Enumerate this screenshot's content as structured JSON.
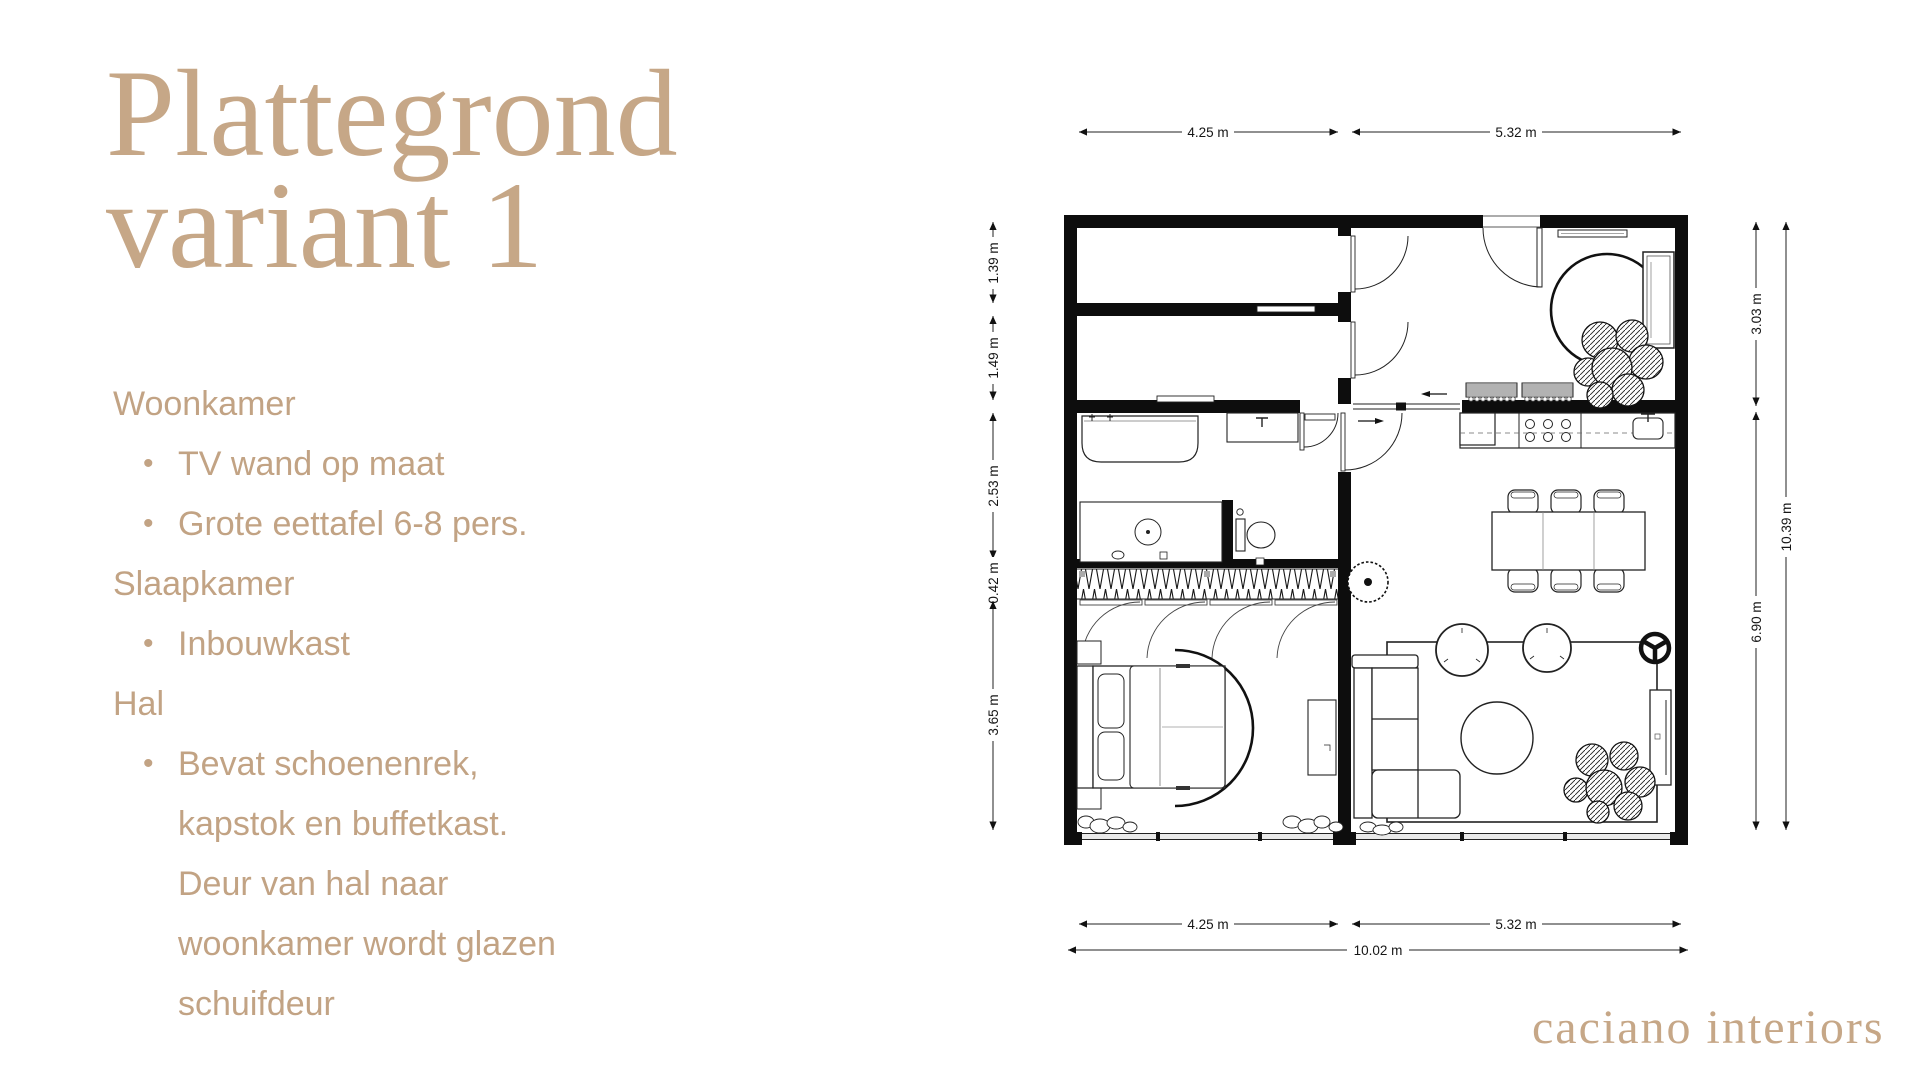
{
  "accent": "#c6a787",
  "title": {
    "line1": "Plattegrond",
    "line2": "variant 1"
  },
  "notes": {
    "items": [
      {
        "text": "Woonkamer",
        "bullet": false
      },
      {
        "text": "TV wand op maat",
        "bullet": true
      },
      {
        "text": "Grote eettafel 6-8 pers.",
        "bullet": true
      },
      {
        "text": "Slaapkamer",
        "bullet": false
      },
      {
        "text": "Inbouwkast",
        "bullet": true
      },
      {
        "text": "Hal",
        "bullet": false
      },
      {
        "text": "Bevat schoenenrek, kapstok en buffetkast. Deur van hal naar woonkamer wordt glazen schuifdeur",
        "bullet": true
      }
    ],
    "bullet_glyph": "•"
  },
  "floorplan": {
    "dims": {
      "top": [
        "4.25 m",
        "5.32 m"
      ],
      "bottom": [
        "4.25 m",
        "5.32 m"
      ],
      "bottom_total": "10.02 m",
      "left": [
        "1.39 m",
        "1.49 m",
        "2.53 m",
        "0.42 m",
        "3.65 m"
      ],
      "right": [
        "3.03 m",
        "6.90 m"
      ],
      "right_total": "10.39 m"
    }
  },
  "brand": "caciano interiors"
}
